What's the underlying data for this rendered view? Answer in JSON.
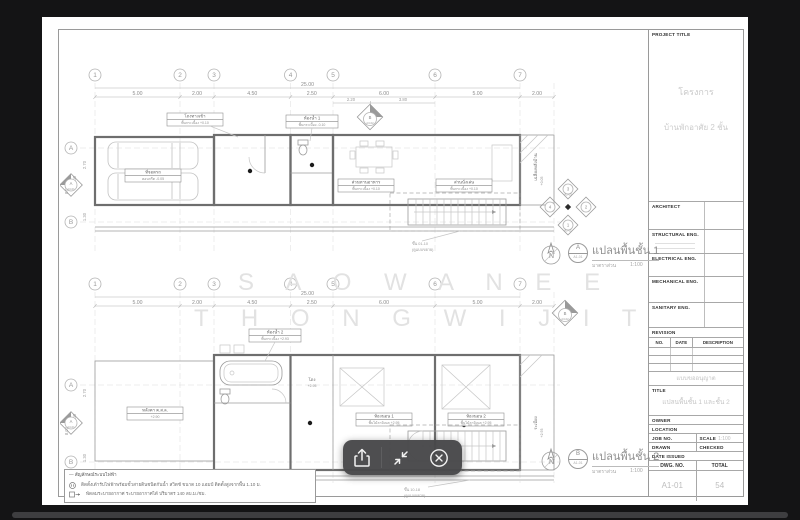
{
  "toolbar": {
    "icons": [
      {
        "name": "share"
      },
      {
        "name": "shrink"
      },
      {
        "name": "close"
      }
    ]
  },
  "sheet": {
    "title_block": {
      "project_title_label": "PROJECT TITLE",
      "project_lines": {
        "line1": "โครงการ",
        "line2": "บ้านพักอาศัย 2 ชั้น"
      },
      "sections": {
        "architect": "ARCHITECT",
        "structural": "STRUCTURAL ENG.",
        "electrical": "ELECTRICAL ENG.",
        "mechanical": "MECHANICAL ENG.",
        "sanitary": "SANITARY ENG."
      },
      "revision": {
        "label": "REVISION",
        "no": "NO.",
        "date": "DATE",
        "description": "DESCRIPTION"
      },
      "permit_note": "แบบขออนุญาต",
      "title_label": "TITLE",
      "sheet_title": "แปลนพื้นชั้น 1 และชั้น 2",
      "owner_label": "OWNER",
      "location_label": "LOCATION",
      "job_no_label": "JOB NO.",
      "scale_label": "SCALE",
      "scale_value": "1:100",
      "drawn_label": "DRAWN",
      "checked_label": "CHECKED",
      "date_issued_label": "DATE ISSUED",
      "dwg_no_label": "DWG. NO.",
      "total_label": "TOTAL",
      "dwg_no": "A1-01",
      "total_sheets": "54"
    },
    "watermark": {
      "line1": "S A O W A N E E",
      "line2": "T H O N G W I J I T"
    },
    "legend": {
      "heading": "— สัญลักษณ์ระบบไฟฟ้า",
      "items": [
        {
          "text": "ติดตั้งเต้ารับไฟฟ้าพร้อมขั้วสายดินชนิดกันน้ำ สวิตช์ ขนาด 10 แอมป์ ติดตั้งสูงจากพื้น 1.10 ม."
        },
        {
          "text": "พัดลมระบายอากาศ ระบายอากาศได้ ปริมาตร 140 ลบ.ม./ชม."
        }
      ]
    },
    "plans": [
      {
        "caption": {
          "ref": "A",
          "sheet": "A1-01",
          "title": "แปลนพื้นชั้น 1",
          "scale_label": "มาตราส่วน",
          "scale": "1:100"
        },
        "grid_cols": [
          "1",
          "2",
          "3",
          "4",
          "5",
          "6",
          "7"
        ],
        "grid_rows": [
          "A",
          "B"
        ],
        "col_dims": [
          "5.00",
          "2.00",
          "4.50",
          "2.50",
          "6.00",
          "5.00"
        ],
        "ext_dim": "2.00",
        "total_dim": "25.00",
        "sub_dims": [
          "2.20",
          "3.80"
        ],
        "row_dims": [
          "2.70",
          "1.30",
          "6.00",
          "8.00"
        ],
        "rooms": {
          "carport": {
            "name": "ที่จอดรถ",
            "finish": "คอนกรีต -0.05"
          },
          "hall": {
            "name": "โถงทางเข้า",
            "finish": "พื้นกระเบื้อง +0.10"
          },
          "bath": {
            "name": "ห้องน้ำ 1",
            "finish": "พื้นกระเบื้อง -0.10"
          },
          "dining": {
            "name": "ส่วนทานอาหาร",
            "finish": "พื้นกระเบื้อง +0.10"
          },
          "living": {
            "name": "ส่วนนั่งเล่น",
            "finish": "พื้นกระเบื้อง +0.10"
          },
          "porch": {
            "name": "เฉลียงหลังบ้าน",
            "finish": "+0.05"
          }
        },
        "stair_note": {
          "line1": "ขึ้น 01-10",
          "line2": "(ดูแบบขยาย)"
        },
        "markers": {
          "left": {
            "ref": "A",
            "sheet": "A3-01"
          },
          "top": {
            "ref": "B",
            "sheet": "A3-02"
          },
          "cluster": [
            {
              "ref": "1",
              "sheet": "A2-01"
            },
            {
              "ref": "2",
              "sheet": "A2-02"
            },
            {
              "ref": "3",
              "sheet": "A2-03"
            },
            {
              "ref": "4",
              "sheet": "A2-04"
            }
          ]
        }
      },
      {
        "caption": {
          "ref": "B",
          "sheet": "A1-01",
          "title": "แปลนพื้นชั้น 2",
          "scale_label": "มาตราส่วน",
          "scale": "1:100"
        },
        "grid_cols": [
          "1",
          "2",
          "3",
          "4",
          "5",
          "6",
          "7"
        ],
        "grid_rows": [
          "A",
          "B"
        ],
        "col_dims": [
          "5.00",
          "2.00",
          "4.50",
          "2.50",
          "6.00",
          "5.00"
        ],
        "ext_dim": "2.00",
        "total_dim": "25.00",
        "row_dims": [
          "2.70",
          "1.30",
          "6.00",
          "8.00"
        ],
        "rooms": {
          "roof": {
            "name": "หลังคา ค.ส.ล.",
            "finish": "+2.90"
          },
          "bath": {
            "name": "ห้องน้ำ 2",
            "finish": "พื้นกระเบื้อง +2.93"
          },
          "hall": {
            "name": "โถง",
            "finish": "+2.95"
          },
          "bed1": {
            "name": "ห้องนอน 1",
            "finish": "พื้นไม้ลามิเนต +2.95"
          },
          "bed2": {
            "name": "ห้องนอน 2",
            "finish": "พื้นไม้ลามิเนต +2.95"
          },
          "balcony": {
            "name": "ระเบียง",
            "finish": "+2.93"
          }
        },
        "stair_note": {
          "line1": "ขึ้น 10-18",
          "line2": "(ดูแบบขยาย)"
        },
        "markers": {
          "left": {
            "ref": "A",
            "sheet": "A3-01"
          },
          "top": {
            "ref": "B",
            "sheet": "A3-02"
          }
        }
      }
    ]
  }
}
